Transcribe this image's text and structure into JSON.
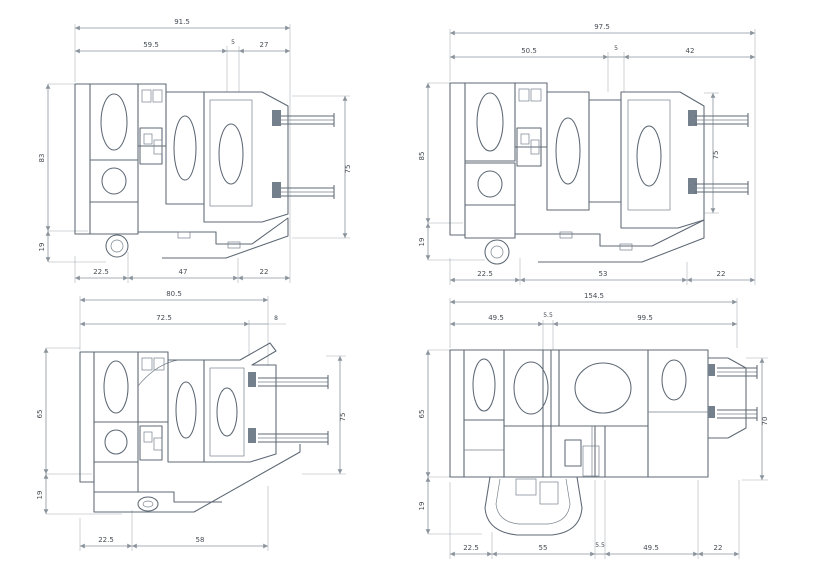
{
  "page": {
    "description": "Scanned technical drawing sheet with four aluminium window profile cross-sections and dimension lines (mm)",
    "background": "#ffffff",
    "line_color": "#5d6874",
    "dimension_color": "#8a939c"
  },
  "drawings": [
    {
      "name": "top-left-section",
      "dims": {
        "top_total": "91.5",
        "top_seg_1": "59.5",
        "top_seg_2": "5",
        "top_seg_3": "27",
        "bot_seg_1": "22.5",
        "bot_seg_2": "47",
        "bot_seg_3": "22",
        "left_main": "83",
        "left_lower": "19",
        "right_height": "75"
      }
    },
    {
      "name": "top-right-section",
      "dims": {
        "top_total": "97.5",
        "top_seg_1": "50.5",
        "top_seg_2": "5",
        "top_seg_3": "42",
        "bot_seg_1": "22.5",
        "bot_seg_2": "53",
        "bot_seg_3": "22",
        "left_main": "85",
        "left_lower": "19",
        "right_height": "75"
      }
    },
    {
      "name": "bottom-left-section",
      "dims": {
        "top_total": "80.5",
        "top_seg_1": "72.5",
        "top_seg_2": "8",
        "bot_seg_1": "22.5",
        "bot_seg_2": "58",
        "left_main": "65",
        "left_lower": "19",
        "right_height": "75"
      }
    },
    {
      "name": "bottom-right-section",
      "dims": {
        "top_total": "154.5",
        "top_seg_1": "49.5",
        "top_seg_2": "5.5",
        "top_seg_3": "99.5",
        "bot_seg_1": "22.5",
        "bot_seg_2": "55",
        "bot_seg_3": "5.5",
        "bot_seg_4": "49.5",
        "bot_seg_5": "22",
        "left_main": "65",
        "left_lower": "19",
        "right_height": "70"
      }
    }
  ]
}
